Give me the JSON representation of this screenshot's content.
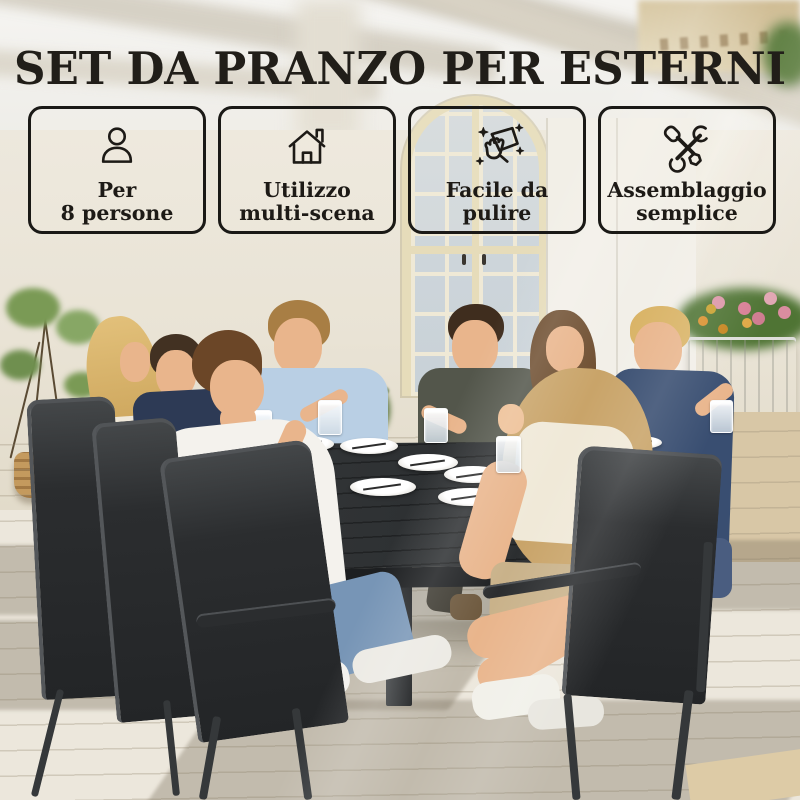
{
  "page": {
    "title": "SET DA PRANZO PER ESTERNI"
  },
  "features": [
    {
      "icon": "person-icon",
      "line1": "Per",
      "line2": "8 persone"
    },
    {
      "icon": "house-icon",
      "line1": "Utilizzo",
      "line2": "multi-scena"
    },
    {
      "icon": "cleaning-wipe-icon",
      "line1": "Facile da",
      "line2": "pulire"
    },
    {
      "icon": "tools-icon",
      "line1": "Assemblaggio",
      "line2": "semplice"
    }
  ],
  "colors": {
    "title_text": "#211e19",
    "badge_border": "#1a1916",
    "badge_text": "#1d1a16",
    "wall": "#e9e3d5",
    "floor": "#ece5d4",
    "table": "#2e3133",
    "chair": "#2b2d2f",
    "window_glass": "#ccd5db",
    "window_frame": "#e6dcba"
  }
}
